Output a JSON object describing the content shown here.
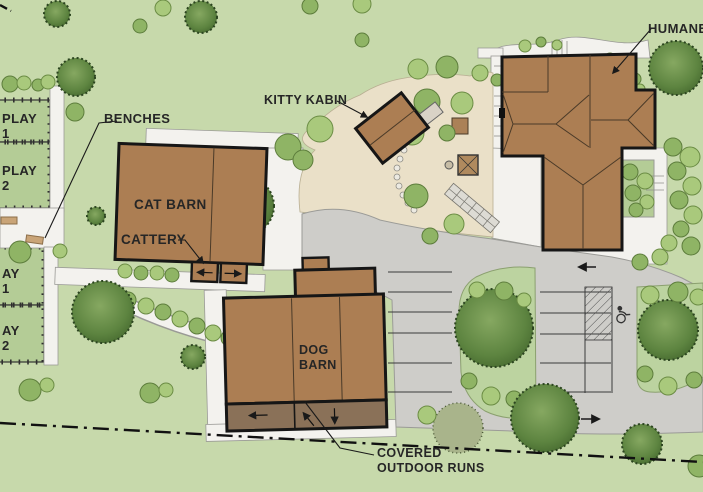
{
  "labels": {
    "humane": "HUMANE",
    "kitty": "KITTY KABIN",
    "cat_barn": "CAT BARN",
    "cattery": "CATTERY",
    "dog1": "DOG",
    "dog2": "BARN",
    "benches": "BENCHES",
    "covered1": "COVERED",
    "covered2": "OUTDOOR RUNS",
    "play_t1_l1": "PLAY",
    "play_t1_l2": "1",
    "play_t2_l1": "PLAY",
    "play_t2_l2": "2",
    "play_b1_l1": "AY",
    "play_b1_l2": "1",
    "play_b2_l1": "AY",
    "play_b2_l2": "2"
  },
  "colors": {
    "lawn": "#c7d9ab",
    "play_yard": "#b4cc96",
    "building_brown": "#ac7e53",
    "covered_runs_brown": "#8a7158",
    "pavement_gray": "#cecdc9",
    "walk_white": "#f3f2ee",
    "courtyard_tan": "#eae0c8",
    "island_green": "#bcd3a0",
    "outline_black": "#161616",
    "bench_tan": "#c9a477"
  },
  "landscape": {
    "trees": [
      [
        57,
        14,
        13,
        "c"
      ],
      [
        201,
        17,
        16,
        "c"
      ],
      [
        163,
        8,
        8,
        "s"
      ],
      [
        140,
        26,
        7,
        "s2"
      ],
      [
        76,
        77,
        19,
        "c"
      ],
      [
        10,
        84,
        8,
        "s2"
      ],
      [
        24,
        83,
        7,
        "s"
      ],
      [
        38,
        85,
        6,
        "s2"
      ],
      [
        48,
        82,
        7,
        "s"
      ],
      [
        75,
        112,
        9,
        "s2"
      ],
      [
        310,
        6,
        8,
        "s2"
      ],
      [
        362,
        4,
        9,
        "s"
      ],
      [
        362,
        40,
        7,
        "s2"
      ],
      [
        288,
        147,
        13,
        "s2"
      ],
      [
        320,
        129,
        13,
        "s"
      ],
      [
        303,
        160,
        10,
        "s2"
      ],
      [
        418,
        69,
        10,
        "s"
      ],
      [
        447,
        67,
        11,
        "s2"
      ],
      [
        480,
        73,
        8,
        "s"
      ],
      [
        497,
        80,
        6,
        "s2"
      ],
      [
        427,
        102,
        13,
        "s2"
      ],
      [
        462,
        103,
        11,
        "s"
      ],
      [
        412,
        133,
        12,
        "s"
      ],
      [
        447,
        133,
        8,
        "s2"
      ],
      [
        416,
        196,
        12,
        "s2"
      ],
      [
        454,
        224,
        10,
        "s"
      ],
      [
        430,
        236,
        8,
        "s2"
      ],
      [
        525,
        46,
        6,
        "s"
      ],
      [
        541,
        42,
        5,
        "s2"
      ],
      [
        557,
        45,
        5,
        "s"
      ],
      [
        610,
        59,
        6,
        "s2"
      ],
      [
        624,
        68,
        6,
        "s"
      ],
      [
        635,
        79,
        6,
        "s2"
      ],
      [
        640,
        89,
        5,
        "s"
      ],
      [
        676,
        68,
        27,
        "c"
      ],
      [
        673,
        147,
        9,
        "s2"
      ],
      [
        690,
        157,
        10,
        "s"
      ],
      [
        677,
        171,
        9,
        "s2"
      ],
      [
        692,
        186,
        9,
        "s"
      ],
      [
        679,
        200,
        9,
        "s2"
      ],
      [
        693,
        215,
        9,
        "s"
      ],
      [
        681,
        229,
        8,
        "s2"
      ],
      [
        669,
        243,
        8,
        "s"
      ],
      [
        691,
        246,
        9,
        "s2"
      ],
      [
        660,
        257,
        8,
        "s"
      ],
      [
        640,
        262,
        8,
        "s2"
      ],
      [
        630,
        172,
        8,
        "s2"
      ],
      [
        645,
        181,
        8,
        "s"
      ],
      [
        633,
        193,
        8,
        "s2"
      ],
      [
        647,
        202,
        7,
        "s"
      ],
      [
        636,
        210,
        7,
        "s2"
      ],
      [
        245,
        206,
        29,
        "c"
      ],
      [
        96,
        216,
        9,
        "c"
      ],
      [
        20,
        252,
        11,
        "s2"
      ],
      [
        60,
        251,
        7,
        "s"
      ],
      [
        125,
        271,
        7,
        "s"
      ],
      [
        141,
        273,
        7,
        "s2"
      ],
      [
        157,
        273,
        7,
        "s"
      ],
      [
        172,
        275,
        7,
        "s2"
      ],
      [
        128,
        300,
        8,
        "s2"
      ],
      [
        146,
        306,
        8,
        "s"
      ],
      [
        163,
        312,
        8,
        "s2"
      ],
      [
        180,
        319,
        8,
        "s"
      ],
      [
        197,
        326,
        8,
        "s2"
      ],
      [
        213,
        333,
        8,
        "s"
      ],
      [
        229,
        338,
        8,
        "s2"
      ],
      [
        245,
        342,
        8,
        "s"
      ],
      [
        103,
        312,
        31,
        "c"
      ],
      [
        193,
        357,
        12,
        "c"
      ],
      [
        30,
        390,
        11,
        "s2"
      ],
      [
        47,
        385,
        7,
        "s"
      ],
      [
        150,
        393,
        10,
        "s2"
      ],
      [
        166,
        390,
        7,
        "s"
      ],
      [
        494,
        328,
        39,
        "c"
      ],
      [
        477,
        290,
        8,
        "s"
      ],
      [
        504,
        291,
        9,
        "s2"
      ],
      [
        524,
        300,
        7,
        "s"
      ],
      [
        469,
        381,
        8,
        "s2"
      ],
      [
        491,
        396,
        9,
        "s"
      ],
      [
        514,
        399,
        8,
        "s2"
      ],
      [
        668,
        330,
        30,
        "c"
      ],
      [
        650,
        295,
        9,
        "s"
      ],
      [
        678,
        292,
        10,
        "s2"
      ],
      [
        698,
        297,
        8,
        "s"
      ],
      [
        645,
        374,
        8,
        "s2"
      ],
      [
        668,
        386,
        9,
        "s"
      ],
      [
        694,
        380,
        8,
        "s2"
      ],
      [
        458,
        428,
        25,
        "sp"
      ],
      [
        545,
        418,
        34,
        "c"
      ],
      [
        642,
        444,
        20,
        "c"
      ],
      [
        699,
        466,
        11,
        "s2"
      ],
      [
        427,
        415,
        9,
        "s"
      ]
    ]
  },
  "parking": {
    "left_rows": {
      "x1": 388,
      "x2": 452,
      "ys": [
        272,
        292,
        312,
        333,
        363,
        392
      ]
    },
    "mid_rows": {
      "x1": 540,
      "x2": 611,
      "ys": [
        292,
        313,
        334,
        363,
        392
      ]
    }
  }
}
